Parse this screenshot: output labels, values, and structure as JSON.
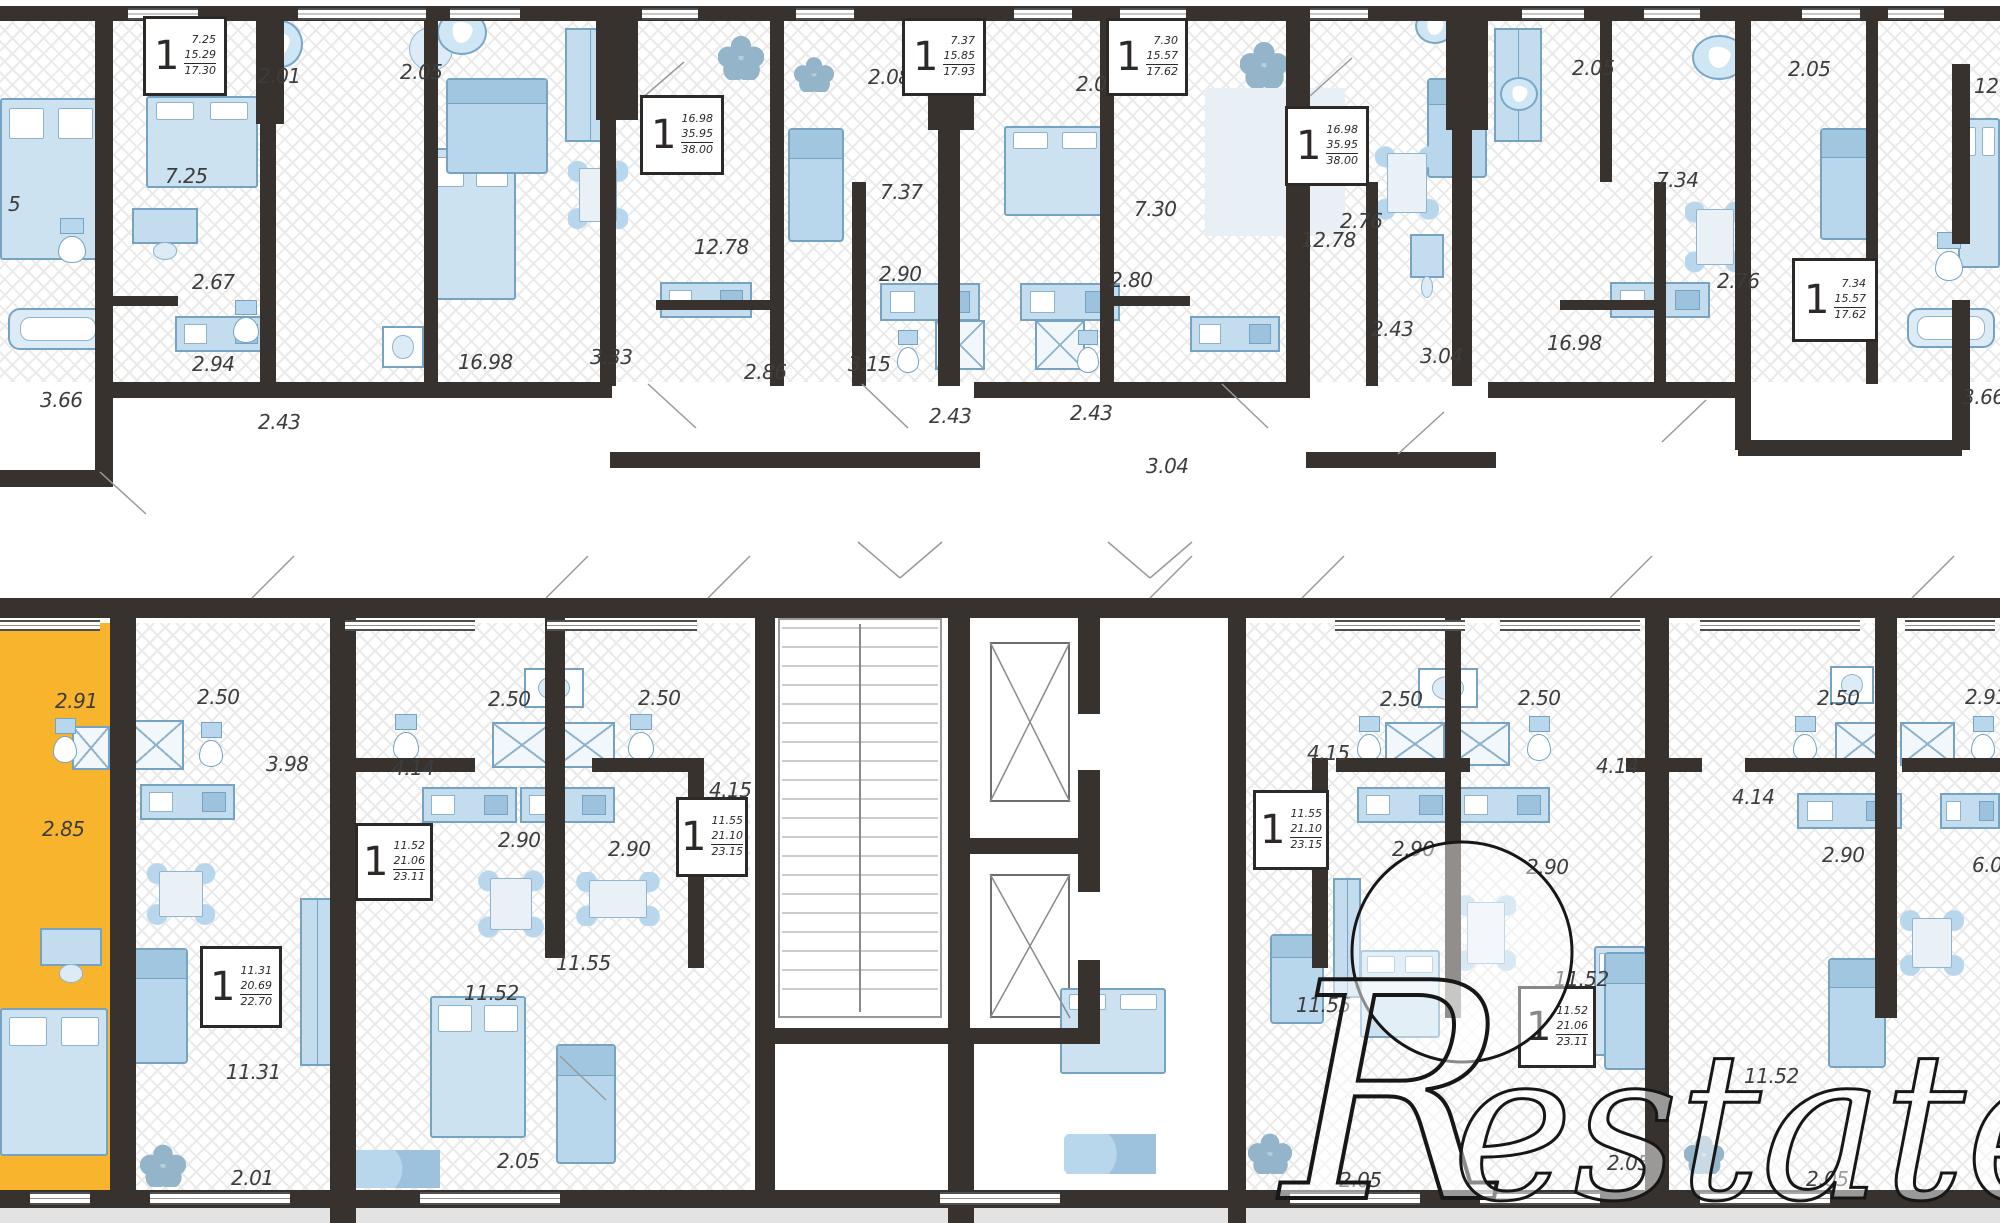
{
  "watermark": {
    "r": "R",
    "rest": "estate"
  },
  "colors": {
    "wall": "#37322e",
    "highlight": "#f7b42c",
    "furniture_fill": "#cde2f1",
    "furniture_stroke": "#76a3c2",
    "label_text": "#3d3d3d",
    "footer_strip": "#e3e3e3"
  },
  "unit_box_rooms": "1",
  "unit_boxes": [
    [
      143,
      16,
      84,
      80,
      "7.25",
      "15.29",
      "17.30"
    ],
    [
      640,
      95,
      84,
      80,
      "16.98",
      "35.95",
      "38.00"
    ],
    [
      902,
      18,
      84,
      78,
      "7.37",
      "15.85",
      "17.93"
    ],
    [
      1106,
      18,
      82,
      78,
      "7.30",
      "15.57",
      "17.62"
    ],
    [
      1285,
      106,
      84,
      80,
      "16.98",
      "35.95",
      "38.00"
    ],
    [
      1792,
      258,
      86,
      84,
      "7.34",
      "15.57",
      "17.62"
    ],
    [
      355,
      823,
      78,
      78,
      "11.52",
      "21.06",
      "23.11"
    ],
    [
      676,
      797,
      72,
      80,
      "11.55",
      "21.10",
      "23.15"
    ],
    [
      1253,
      790,
      76,
      80,
      "11.55",
      "21.10",
      "23.15"
    ],
    [
      1518,
      986,
      78,
      82,
      "11.52",
      "21.06",
      "23.11"
    ],
    [
      200,
      946,
      82,
      82,
      "11.31",
      "20.69",
      "22.70"
    ]
  ],
  "dimension_labels": [
    [
      "5",
      8,
      194
    ],
    [
      "7.25",
      165,
      166
    ],
    [
      "2.01",
      258,
      66
    ],
    [
      "2.05",
      400,
      62
    ],
    [
      "2.67",
      192,
      272
    ],
    [
      "2.94",
      192,
      354
    ],
    [
      "2.43",
      258,
      412
    ],
    [
      "3.66",
      40,
      390
    ],
    [
      "16.98",
      458,
      352
    ],
    [
      "3.33",
      590,
      347
    ],
    [
      "2.86",
      744,
      362
    ],
    [
      "12.78",
      694,
      237
    ],
    [
      "2.08",
      868,
      67
    ],
    [
      "7.37",
      880,
      182
    ],
    [
      "2.90",
      879,
      264
    ],
    [
      "3.15",
      848,
      354
    ],
    [
      "2.43",
      929,
      406
    ],
    [
      "2.43",
      1070,
      403
    ],
    [
      "2.80",
      1110,
      270
    ],
    [
      "3.04",
      1146,
      456
    ],
    [
      "2.05",
      1076,
      74
    ],
    [
      "7.30",
      1134,
      199
    ],
    [
      "12.78",
      1301,
      230
    ],
    [
      "2.43",
      1371,
      319
    ],
    [
      "3.04",
      1420,
      346
    ],
    [
      "2.76",
      1340,
      211
    ],
    [
      "16.98",
      1547,
      333
    ],
    [
      "2.05",
      1572,
      58
    ],
    [
      "2.05",
      1788,
      59
    ],
    [
      "7.34",
      1656,
      170
    ],
    [
      "2.76",
      1717,
      271
    ],
    [
      "3.66",
      1962,
      387
    ],
    [
      "12.24",
      1974,
      76
    ],
    [
      "2.91",
      55,
      691
    ],
    [
      "2.85",
      42,
      819
    ],
    [
      "2.50",
      197,
      687
    ],
    [
      "3.98",
      266,
      754
    ],
    [
      "2.50",
      488,
      689
    ],
    [
      "2.50",
      638,
      688
    ],
    [
      "4.14",
      392,
      758
    ],
    [
      "4.15",
      709,
      780
    ],
    [
      "2.90",
      498,
      830
    ],
    [
      "2.90",
      608,
      839
    ],
    [
      "11.55",
      556,
      953
    ],
    [
      "11.31",
      226,
      1062
    ],
    [
      "11.52",
      464,
      983
    ],
    [
      "2.01",
      231,
      1168
    ],
    [
      "2.05",
      497,
      1151
    ],
    [
      "4.15",
      1307,
      743
    ],
    [
      "2.50",
      1380,
      689
    ],
    [
      "2.50",
      1518,
      688
    ],
    [
      "4.14",
      1596,
      756
    ],
    [
      "2.90",
      1392,
      839
    ],
    [
      "2.90",
      1526,
      857
    ],
    [
      "11.55",
      1296,
      995
    ],
    [
      "11.52",
      1554,
      969
    ],
    [
      "2.05",
      1339,
      1170
    ],
    [
      "2.50",
      1817,
      688
    ],
    [
      "2.91",
      1965,
      687
    ],
    [
      "4.14",
      1732,
      787
    ],
    [
      "2.90",
      1822,
      845
    ],
    [
      "6.03",
      1972,
      855
    ],
    [
      "11.52",
      1744,
      1066
    ],
    [
      "2.05",
      1607,
      1153
    ],
    [
      "2.05",
      1806,
      1169
    ]
  ],
  "floor_hatch": [
    [
      0,
      21,
      2000,
      361
    ],
    [
      0,
      623,
      750,
      569
    ],
    [
      1245,
      623,
      755,
      569
    ]
  ],
  "highlight_unit": {
    "zones": [
      [
        0,
        623,
        110,
        569
      ]
    ]
  },
  "walls": [
    [
      0,
      6,
      2000,
      15
    ],
    [
      95,
      6,
      18,
      481
    ],
    [
      256,
      6,
      28,
      118
    ],
    [
      260,
      118,
      16,
      268
    ],
    [
      424,
      6,
      14,
      380
    ],
    [
      596,
      6,
      42,
      114
    ],
    [
      600,
      118,
      16,
      268
    ],
    [
      770,
      6,
      14,
      380
    ],
    [
      852,
      182,
      14,
      204
    ],
    [
      928,
      6,
      46,
      124
    ],
    [
      938,
      128,
      22,
      258
    ],
    [
      1100,
      6,
      14,
      380
    ],
    [
      1286,
      6,
      24,
      380
    ],
    [
      1366,
      182,
      12,
      204
    ],
    [
      1446,
      6,
      42,
      124
    ],
    [
      1452,
      128,
      20,
      258
    ],
    [
      1600,
      6,
      12,
      176
    ],
    [
      1654,
      182,
      12,
      204
    ],
    [
      1735,
      6,
      16,
      444
    ],
    [
      1866,
      6,
      12,
      378
    ],
    [
      1952,
      64,
      18,
      180
    ],
    [
      1952,
      300,
      18,
      150
    ],
    [
      95,
      382,
      517,
      16
    ],
    [
      610,
      452,
      370,
      16
    ],
    [
      974,
      382,
      336,
      16
    ],
    [
      1306,
      452,
      190,
      16
    ],
    [
      1488,
      382,
      252,
      16
    ],
    [
      1738,
      440,
      224,
      16
    ],
    [
      0,
      470,
      97,
      17
    ],
    [
      96,
      296,
      82,
      10
    ],
    [
      656,
      300,
      116,
      10
    ],
    [
      1106,
      296,
      84,
      10
    ],
    [
      1560,
      300,
      96,
      10
    ],
    [
      0,
      598,
      2000,
      20
    ],
    [
      110,
      598,
      26,
      594
    ],
    [
      330,
      598,
      26,
      625
    ],
    [
      545,
      598,
      20,
      360
    ],
    [
      755,
      598,
      20,
      450
    ],
    [
      948,
      614,
      22,
      414
    ],
    [
      948,
      1028,
      26,
      195
    ],
    [
      1078,
      614,
      22,
      100
    ],
    [
      1078,
      770,
      22,
      122
    ],
    [
      1078,
      960,
      22,
      84
    ],
    [
      1228,
      598,
      18,
      625
    ],
    [
      1445,
      598,
      16,
      420
    ],
    [
      1645,
      598,
      24,
      594
    ],
    [
      1875,
      598,
      22,
      420
    ],
    [
      948,
      838,
      152,
      16
    ],
    [
      755,
      1028,
      345,
      16
    ],
    [
      755,
      1044,
      20,
      148
    ],
    [
      345,
      758,
      130,
      14
    ],
    [
      592,
      758,
      96,
      14
    ],
    [
      688,
      758,
      16,
      210
    ],
    [
      1336,
      758,
      134,
      14
    ],
    [
      1626,
      758,
      76,
      14
    ],
    [
      1312,
      758,
      16,
      210
    ],
    [
      1745,
      758,
      130,
      14
    ],
    [
      1902,
      758,
      98,
      14
    ],
    [
      0,
      1190,
      2000,
      18
    ]
  ],
  "windows": [
    [
      128,
      8,
      70,
      12
    ],
    [
      298,
      8,
      128,
      12
    ],
    [
      450,
      8,
      70,
      12
    ],
    [
      642,
      8,
      56,
      12
    ],
    [
      796,
      8,
      58,
      12
    ],
    [
      1014,
      8,
      58,
      12
    ],
    [
      1120,
      8,
      66,
      12
    ],
    [
      1310,
      8,
      58,
      12
    ],
    [
      1522,
      8,
      62,
      12
    ],
    [
      1644,
      8,
      56,
      12
    ],
    [
      1802,
      8,
      58,
      12
    ],
    [
      1888,
      8,
      56,
      12
    ],
    [
      0,
      620,
      100,
      11
    ],
    [
      345,
      620,
      130,
      11
    ],
    [
      547,
      620,
      150,
      11
    ],
    [
      1335,
      620,
      130,
      11
    ],
    [
      1500,
      620,
      140,
      11
    ],
    [
      1700,
      620,
      160,
      11
    ],
    [
      1905,
      620,
      90,
      11
    ],
    [
      30,
      1192,
      60,
      13
    ],
    [
      150,
      1192,
      140,
      13
    ],
    [
      420,
      1192,
      140,
      13
    ],
    [
      940,
      1192,
      120,
      13
    ],
    [
      1290,
      1192,
      130,
      13
    ],
    [
      1480,
      1192,
      120,
      13
    ],
    [
      1700,
      1192,
      130,
      13
    ]
  ],
  "core": {
    "stairs": [
      778,
      618,
      164,
      400
    ],
    "elevators": [
      [
        990,
        642,
        80,
        160
      ],
      [
        990,
        874,
        80,
        144
      ]
    ]
  },
  "door_lines": [
    [
      648,
      384,
      696,
      428
    ],
    [
      862,
      384,
      908,
      428
    ],
    [
      1222,
      384,
      1268,
      428
    ],
    [
      1398,
      454,
      1444,
      412
    ],
    [
      1662,
      442,
      1706,
      400
    ],
    [
      100,
      472,
      146,
      514
    ],
    [
      252,
      598,
      294,
      556
    ],
    [
      546,
      598,
      588,
      556
    ],
    [
      708,
      598,
      750,
      556
    ],
    [
      1150,
      598,
      1192,
      556
    ],
    [
      1302,
      598,
      1344,
      556
    ],
    [
      1610,
      598,
      1652,
      556
    ],
    [
      1912,
      598,
      1954,
      556
    ],
    [
      858,
      542,
      900,
      578
    ],
    [
      900,
      578,
      942,
      542
    ],
    [
      1108,
      542,
      1150,
      578
    ],
    [
      1150,
      578,
      1192,
      542
    ],
    [
      640,
      100,
      684,
      62
    ],
    [
      1310,
      96,
      1352,
      58
    ],
    [
      560,
      1056,
      606,
      1100
    ]
  ],
  "furniture": {
    "bed": [
      [
        0,
        98,
        102,
        162
      ],
      [
        146,
        96,
        112,
        92
      ],
      [
        424,
        148,
        92,
        152
      ],
      [
        1004,
        126,
        102,
        90
      ],
      [
        1958,
        118,
        42,
        150
      ],
      [
        0,
        1008,
        108,
        148
      ],
      [
        430,
        996,
        96,
        142
      ],
      [
        1060,
        988,
        106,
        86
      ],
      [
        1360,
        950,
        80,
        88
      ],
      [
        1594,
        946,
        52,
        110
      ]
    ],
    "sofa": [
      [
        446,
        78,
        102,
        96
      ],
      [
        788,
        128,
        56,
        114
      ],
      [
        1427,
        78,
        60,
        100
      ],
      [
        1820,
        128,
        58,
        112
      ],
      [
        132,
        948,
        56,
        116
      ],
      [
        556,
        1044,
        60,
        120
      ],
      [
        1270,
        934,
        54,
        90
      ],
      [
        1604,
        952,
        54,
        118
      ],
      [
        1828,
        958,
        58,
        110
      ]
    ],
    "wardrobe": [
      [
        565,
        28,
        50,
        114
      ],
      [
        1494,
        28,
        48,
        114
      ],
      [
        300,
        898,
        34,
        168
      ],
      [
        1333,
        878,
        28,
        120
      ]
    ],
    "table4": [
      [
        568,
        158,
        60,
        74
      ],
      [
        1375,
        142,
        64,
        82
      ],
      [
        1685,
        198,
        60,
        78
      ],
      [
        146,
        862,
        70,
        64
      ],
      [
        478,
        868,
        66,
        72
      ],
      [
        572,
        872,
        92,
        54
      ],
      [
        1456,
        890,
        60,
        86
      ],
      [
        1900,
        908,
        64,
        70
      ]
    ],
    "tableR": [
      [
        400,
        18,
        62,
        62
      ]
    ],
    "kitchen": [
      [
        175,
        316,
        92,
        36
      ],
      [
        660,
        282,
        92,
        36
      ],
      [
        880,
        283,
        100,
        38
      ],
      [
        1020,
        283,
        100,
        38
      ],
      [
        1190,
        316,
        90,
        36
      ],
      [
        1610,
        282,
        100,
        36
      ],
      [
        140,
        784,
        95,
        36
      ],
      [
        422,
        787,
        95,
        36
      ],
      [
        520,
        787,
        95,
        36
      ],
      [
        1357,
        787,
        95,
        36
      ],
      [
        1455,
        787,
        95,
        36
      ],
      [
        1797,
        793,
        105,
        36
      ],
      [
        1940,
        793,
        60,
        36
      ]
    ],
    "tub": [
      [
        8,
        308,
        100,
        42
      ],
      [
        1907,
        308,
        88,
        40
      ]
    ],
    "shower": [
      [
        128,
        720,
        56,
        50
      ],
      [
        72,
        726,
        38,
        44
      ],
      [
        492,
        722,
        60,
        46
      ],
      [
        555,
        722,
        60,
        46
      ],
      [
        935,
        320,
        50,
        50
      ],
      [
        1035,
        320,
        50,
        50
      ],
      [
        1385,
        722,
        60,
        44
      ],
      [
        1450,
        722,
        60,
        44
      ],
      [
        1835,
        722,
        55,
        44
      ],
      [
        1900,
        722,
        55,
        44
      ]
    ],
    "toilet": [
      [
        55,
        218,
        34,
        46
      ],
      [
        230,
        300,
        32,
        44
      ],
      [
        894,
        330,
        28,
        44
      ],
      [
        1074,
        330,
        28,
        44
      ],
      [
        1932,
        232,
        34,
        50
      ],
      [
        50,
        718,
        30,
        46
      ],
      [
        196,
        722,
        30,
        46
      ],
      [
        390,
        714,
        32,
        48
      ],
      [
        625,
        714,
        32,
        48
      ],
      [
        1354,
        716,
        30,
        46
      ],
      [
        1524,
        716,
        30,
        46
      ],
      [
        1790,
        716,
        30,
        46
      ],
      [
        1968,
        716,
        30,
        46
      ]
    ],
    "washer": [
      [
        382,
        326,
        42,
        42
      ],
      [
        524,
        668,
        60,
        40
      ],
      [
        1418,
        668,
        60,
        40
      ],
      [
        1830,
        666,
        44,
        38
      ]
    ],
    "desk": [
      [
        132,
        208,
        66,
        36
      ],
      [
        40,
        928,
        62,
        38
      ],
      [
        1410,
        234,
        34,
        44
      ]
    ],
    "plant": [
      [
        718,
        34,
        46,
        46
      ],
      [
        794,
        56,
        40,
        36
      ],
      [
        1240,
        40,
        48,
        48
      ],
      [
        140,
        1143,
        46,
        44
      ],
      [
        1248,
        1132,
        44,
        42
      ],
      [
        1684,
        1134,
        40,
        40
      ]
    ],
    "drop": [
      [
        258,
        20,
        45,
        48
      ],
      [
        437,
        10,
        50,
        45
      ],
      [
        1415,
        8,
        40,
        36
      ],
      [
        1500,
        77,
        38,
        34
      ],
      [
        1692,
        35,
        55,
        45
      ]
    ],
    "pouf": [
      [
        352,
        1150,
        88,
        38
      ],
      [
        1064,
        1134,
        92,
        40
      ]
    ],
    "rug": [
      [
        1205,
        88,
        140,
        148
      ]
    ]
  },
  "footer_strip": [
    0,
    1206,
    2000,
    17
  ]
}
